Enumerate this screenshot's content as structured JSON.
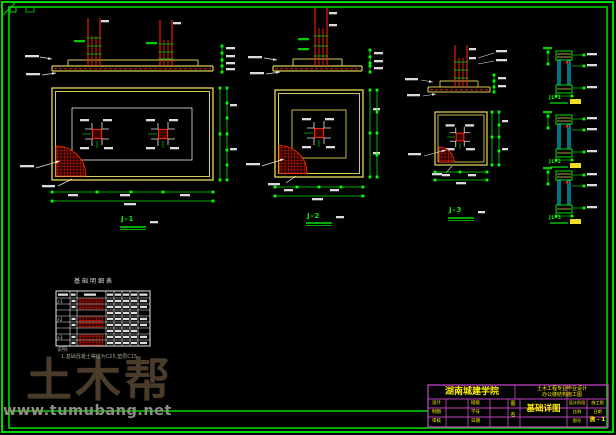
{
  "watermark": {
    "brand": "土木帮",
    "url": "www.tumubang.net",
    "brand_color": "#4a3b2b",
    "url_color": "#8e8e82"
  },
  "drawings": [
    {
      "label": "J-1"
    },
    {
      "label": "J-2"
    },
    {
      "label": "J-3"
    }
  ],
  "details": [
    {
      "label": "JL-1"
    },
    {
      "label": "JL-2"
    },
    {
      "label": "JL-3"
    }
  ],
  "table": {
    "title": "基础明细表",
    "row_groups": [
      "J-1",
      "J-2",
      "J-3"
    ]
  },
  "notes": {
    "heading": "说明:",
    "line1": "1.基础混凝土等级为C25,垫层C15"
  },
  "titleblock": {
    "org": "湖南城建学院",
    "project_line1": "土木工程专业毕业设计",
    "project_line2": "办公楼结构施工图",
    "drawing_name": "基础详图",
    "fields": {
      "design": "设计",
      "draft": "制图",
      "check": "审核",
      "clazz": "班级",
      "sid": "学号",
      "date": "日期",
      "fig": "图",
      "name": "名"
    },
    "right": {
      "r1a": "设计阶段",
      "r1b": "施工图",
      "r2a": "比例",
      "r2b": "日期",
      "r3a": "图号",
      "sheet": "施 - 1"
    }
  },
  "colors": {
    "frame_green": "#00d800",
    "line_yellow": "#d8cc50",
    "line_red": "#ff2200",
    "line_cyan": "#00e5ff",
    "titleblock_magenta": "#c042c0",
    "text_yellow": "#ffef00"
  }
}
